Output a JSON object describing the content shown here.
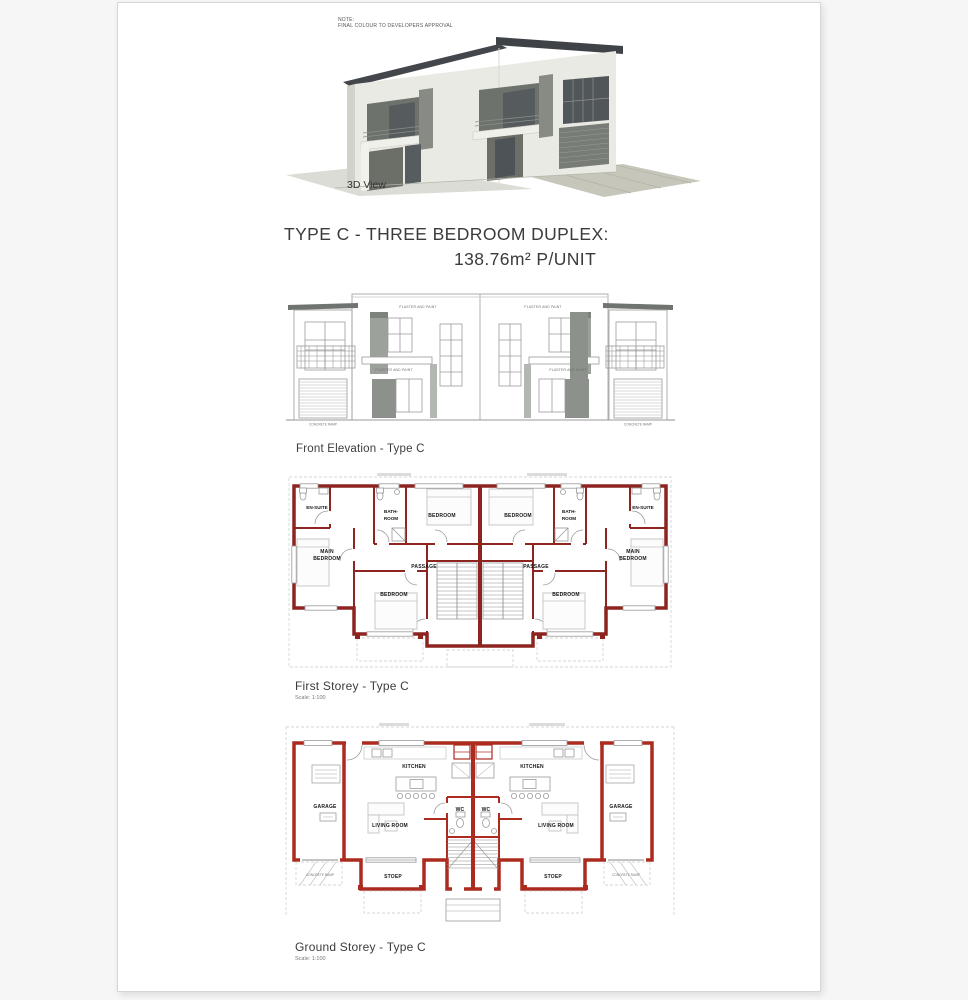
{
  "page": {
    "note": {
      "line1": "NOTE:",
      "line2": "FINAL COLOUR TO DEVELOPERS APPROVAL"
    },
    "view3d_label": "3D View",
    "title": {
      "line1": "TYPE C - THREE BEDROOM DUPLEX:",
      "line2": "138.76m² P/UNIT"
    },
    "elevation": {
      "caption": "Front Elevation - Type C",
      "plaster": "PLASTER AND PAINT",
      "ramp": "CONCRETE RAMP"
    },
    "first_storey": {
      "caption": "First Storey - Type C",
      "scale": "Scale: 1:100",
      "rooms": {
        "en_suite": "EN-SUITE",
        "main_l1": "MAIN",
        "main_l2": "BEDROOM",
        "bath_l1": "BATH-",
        "bath_l2": "ROOM",
        "bedroom": "BEDROOM",
        "passage": "PASSAGE"
      }
    },
    "ground_storey": {
      "caption": "Ground Storey - Type C",
      "scale": "Scale: 1:100",
      "rooms": {
        "garage": "GARAGE",
        "kitchen": "KITCHEN",
        "living_room": "LIVING ROOM",
        "wc": "WC",
        "stoep": "STOEP",
        "ramp": "CONCRETE RAMP"
      }
    },
    "colors": {
      "wall_red_first": "#8e2420",
      "wall_red_ground": "#ac2a1e",
      "roof_dark": "#43474b",
      "line_gray": "#9b9b9b"
    }
  }
}
